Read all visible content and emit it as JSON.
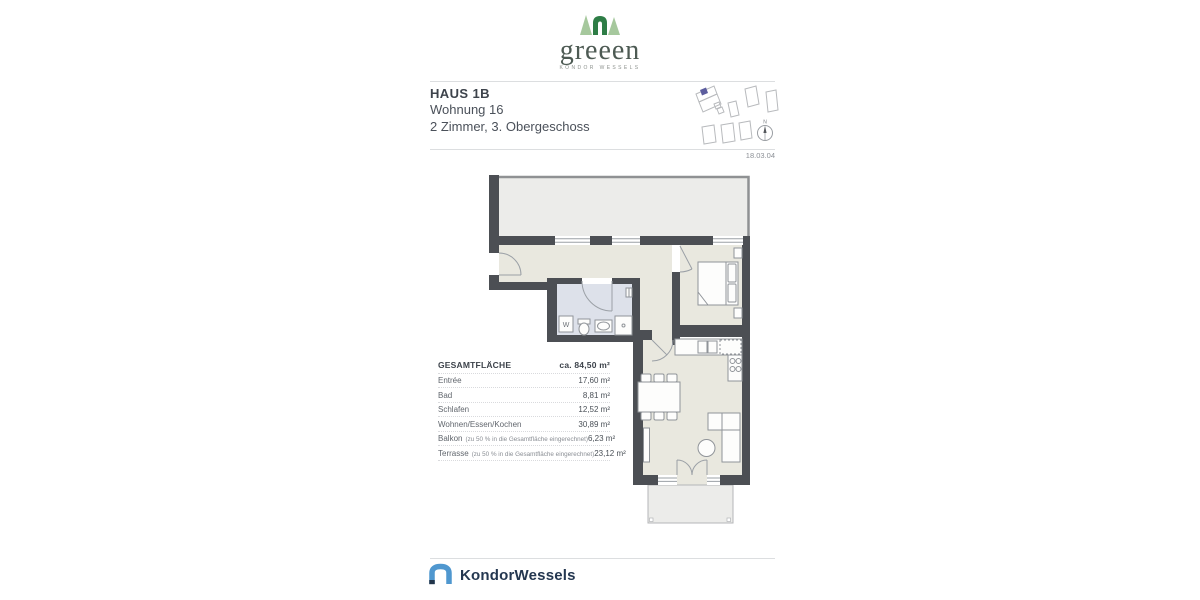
{
  "brand_top": {
    "name": "greeen",
    "tagline": "KONDOR WESSELS"
  },
  "header": {
    "title": "HAUS 1B",
    "subtitle": "Wohnung 16",
    "detail": "2 Zimmer, 3. Obergeschoss"
  },
  "date": "18.03.04",
  "compass": {
    "label": "N"
  },
  "area_table": {
    "header": {
      "label": "GESAMTFLÄCHE",
      "value": "ca. 84,50 m²"
    },
    "rows": [
      {
        "label": "Entrée",
        "note": "",
        "value": "17,60 m²"
      },
      {
        "label": "Bad",
        "note": "",
        "value": "8,81 m²"
      },
      {
        "label": "Schlafen",
        "note": "",
        "value": "12,52 m²"
      },
      {
        "label": "Wohnen/Essen/Kochen",
        "note": "",
        "value": "30,89 m²"
      },
      {
        "label": "Balkon",
        "note": "(zu 50 % in die Gesamtfläche eingerechnet)",
        "value": "6,23 m²"
      },
      {
        "label": "Terrasse",
        "note": "(zu 50 % in die Gesamtfläche eingerechnet)",
        "value": "23,12 m²"
      }
    ]
  },
  "floorplan": {
    "washer_label": "W"
  },
  "brand_bottom": {
    "name": "KondorWessels"
  },
  "colors": {
    "wall": "#4c4f54",
    "floor": "#e9e8df",
    "bath": "#dde1ea",
    "outdoor": "#ececea",
    "accent_purple": "#5c5d9e",
    "green_dark": "#2e7d46",
    "green_light": "#a6c89d",
    "blue": "#4f97cf",
    "navy": "#22354a"
  }
}
